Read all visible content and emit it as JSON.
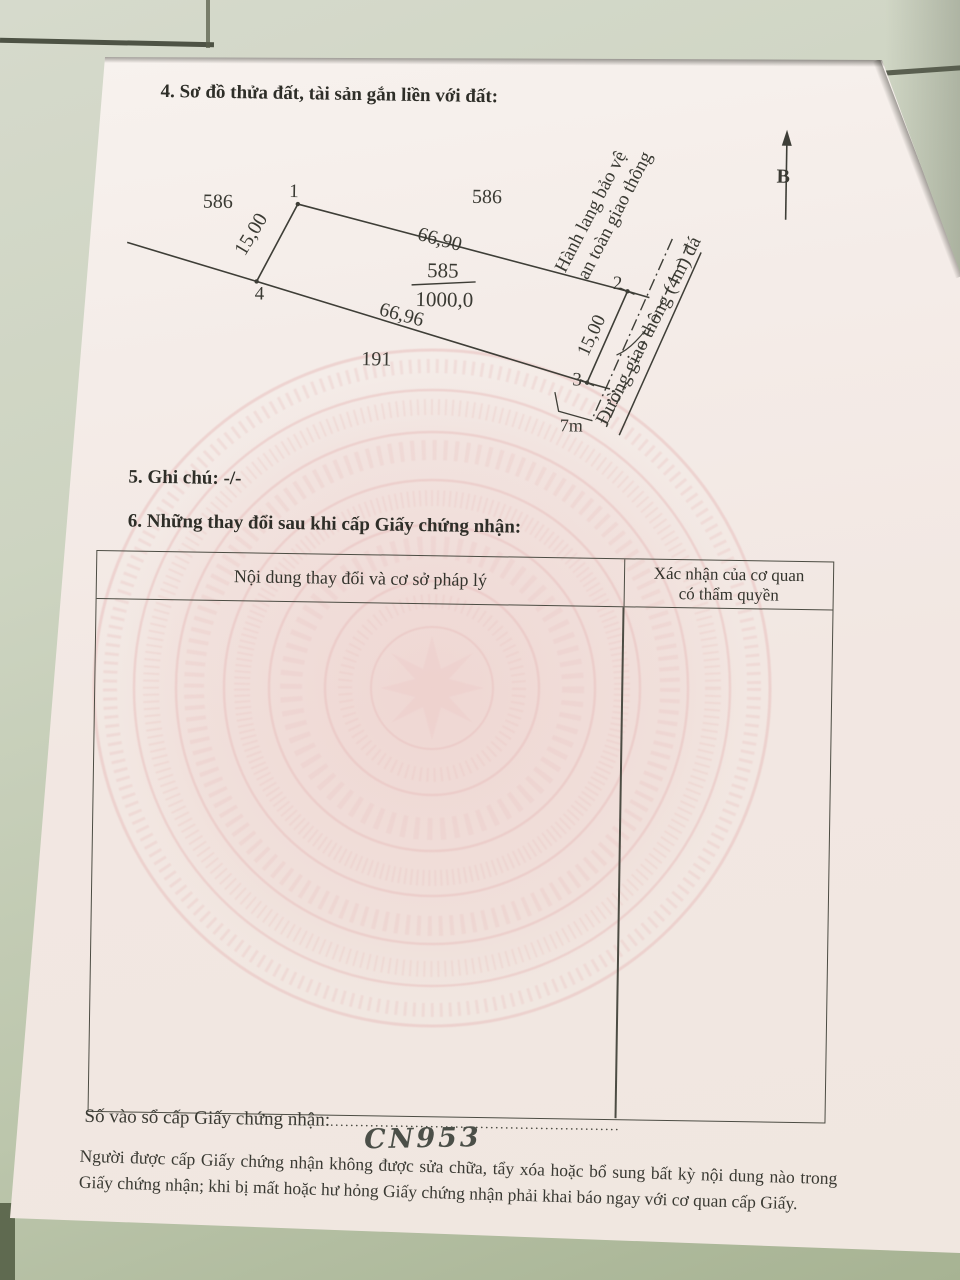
{
  "document": {
    "section4_title": "4. Sơ đồ thửa đất, tài sản gắn liền với đất:",
    "section5_title": "5. Ghi chú: -/-",
    "section6_title": "6. Những thay đổi sau khi cấp Giấy chứng nhận:",
    "table": {
      "col1_header": "Nội dung thay đổi và cơ sở pháp lý",
      "col2_header_line1": "Xác nhận của cơ quan",
      "col2_header_line2": "có thẩm quyền"
    },
    "registry": {
      "label": "Số vào sổ cấp Giấy chứng nhận:",
      "dots": "..........................................................",
      "number": "CN953"
    },
    "notice": "Người được cấp Giấy chứng nhận không được sửa chữa, tẩy xóa hoặc bổ sung bất kỳ nội dung nào trong Giấy chứng nhận; khi bị mất hoặc hư hỏng Giấy chứng nhận phải khai báo ngay với cơ quan cấp Giấy."
  },
  "diagram": {
    "north_label": "B",
    "neighbor_plot_left": "586",
    "neighbor_plot_top": "586",
    "neighbor_plot_bottom": "191",
    "vertex_1": "1",
    "vertex_2": "2",
    "vertex_3": "3",
    "vertex_4": "4",
    "top_edge_length": "66,90",
    "bottom_edge_length": "66,96",
    "left_edge_length": "15,00",
    "right_edge_length": "15,00",
    "parcel_number": "585",
    "parcel_area": "1000,0",
    "road_frontage": "7m",
    "corridor_label_line1": "Hành lang bảo vệ",
    "corridor_label_line2": "an toàn giao thông",
    "road_label": "Đường giao thông (4m) đá"
  },
  "colors": {
    "paper": "#f3eae5",
    "watermark_pink": "#e9c2c0",
    "wall_green": "#bcc6ac",
    "ink": "#33332c"
  }
}
